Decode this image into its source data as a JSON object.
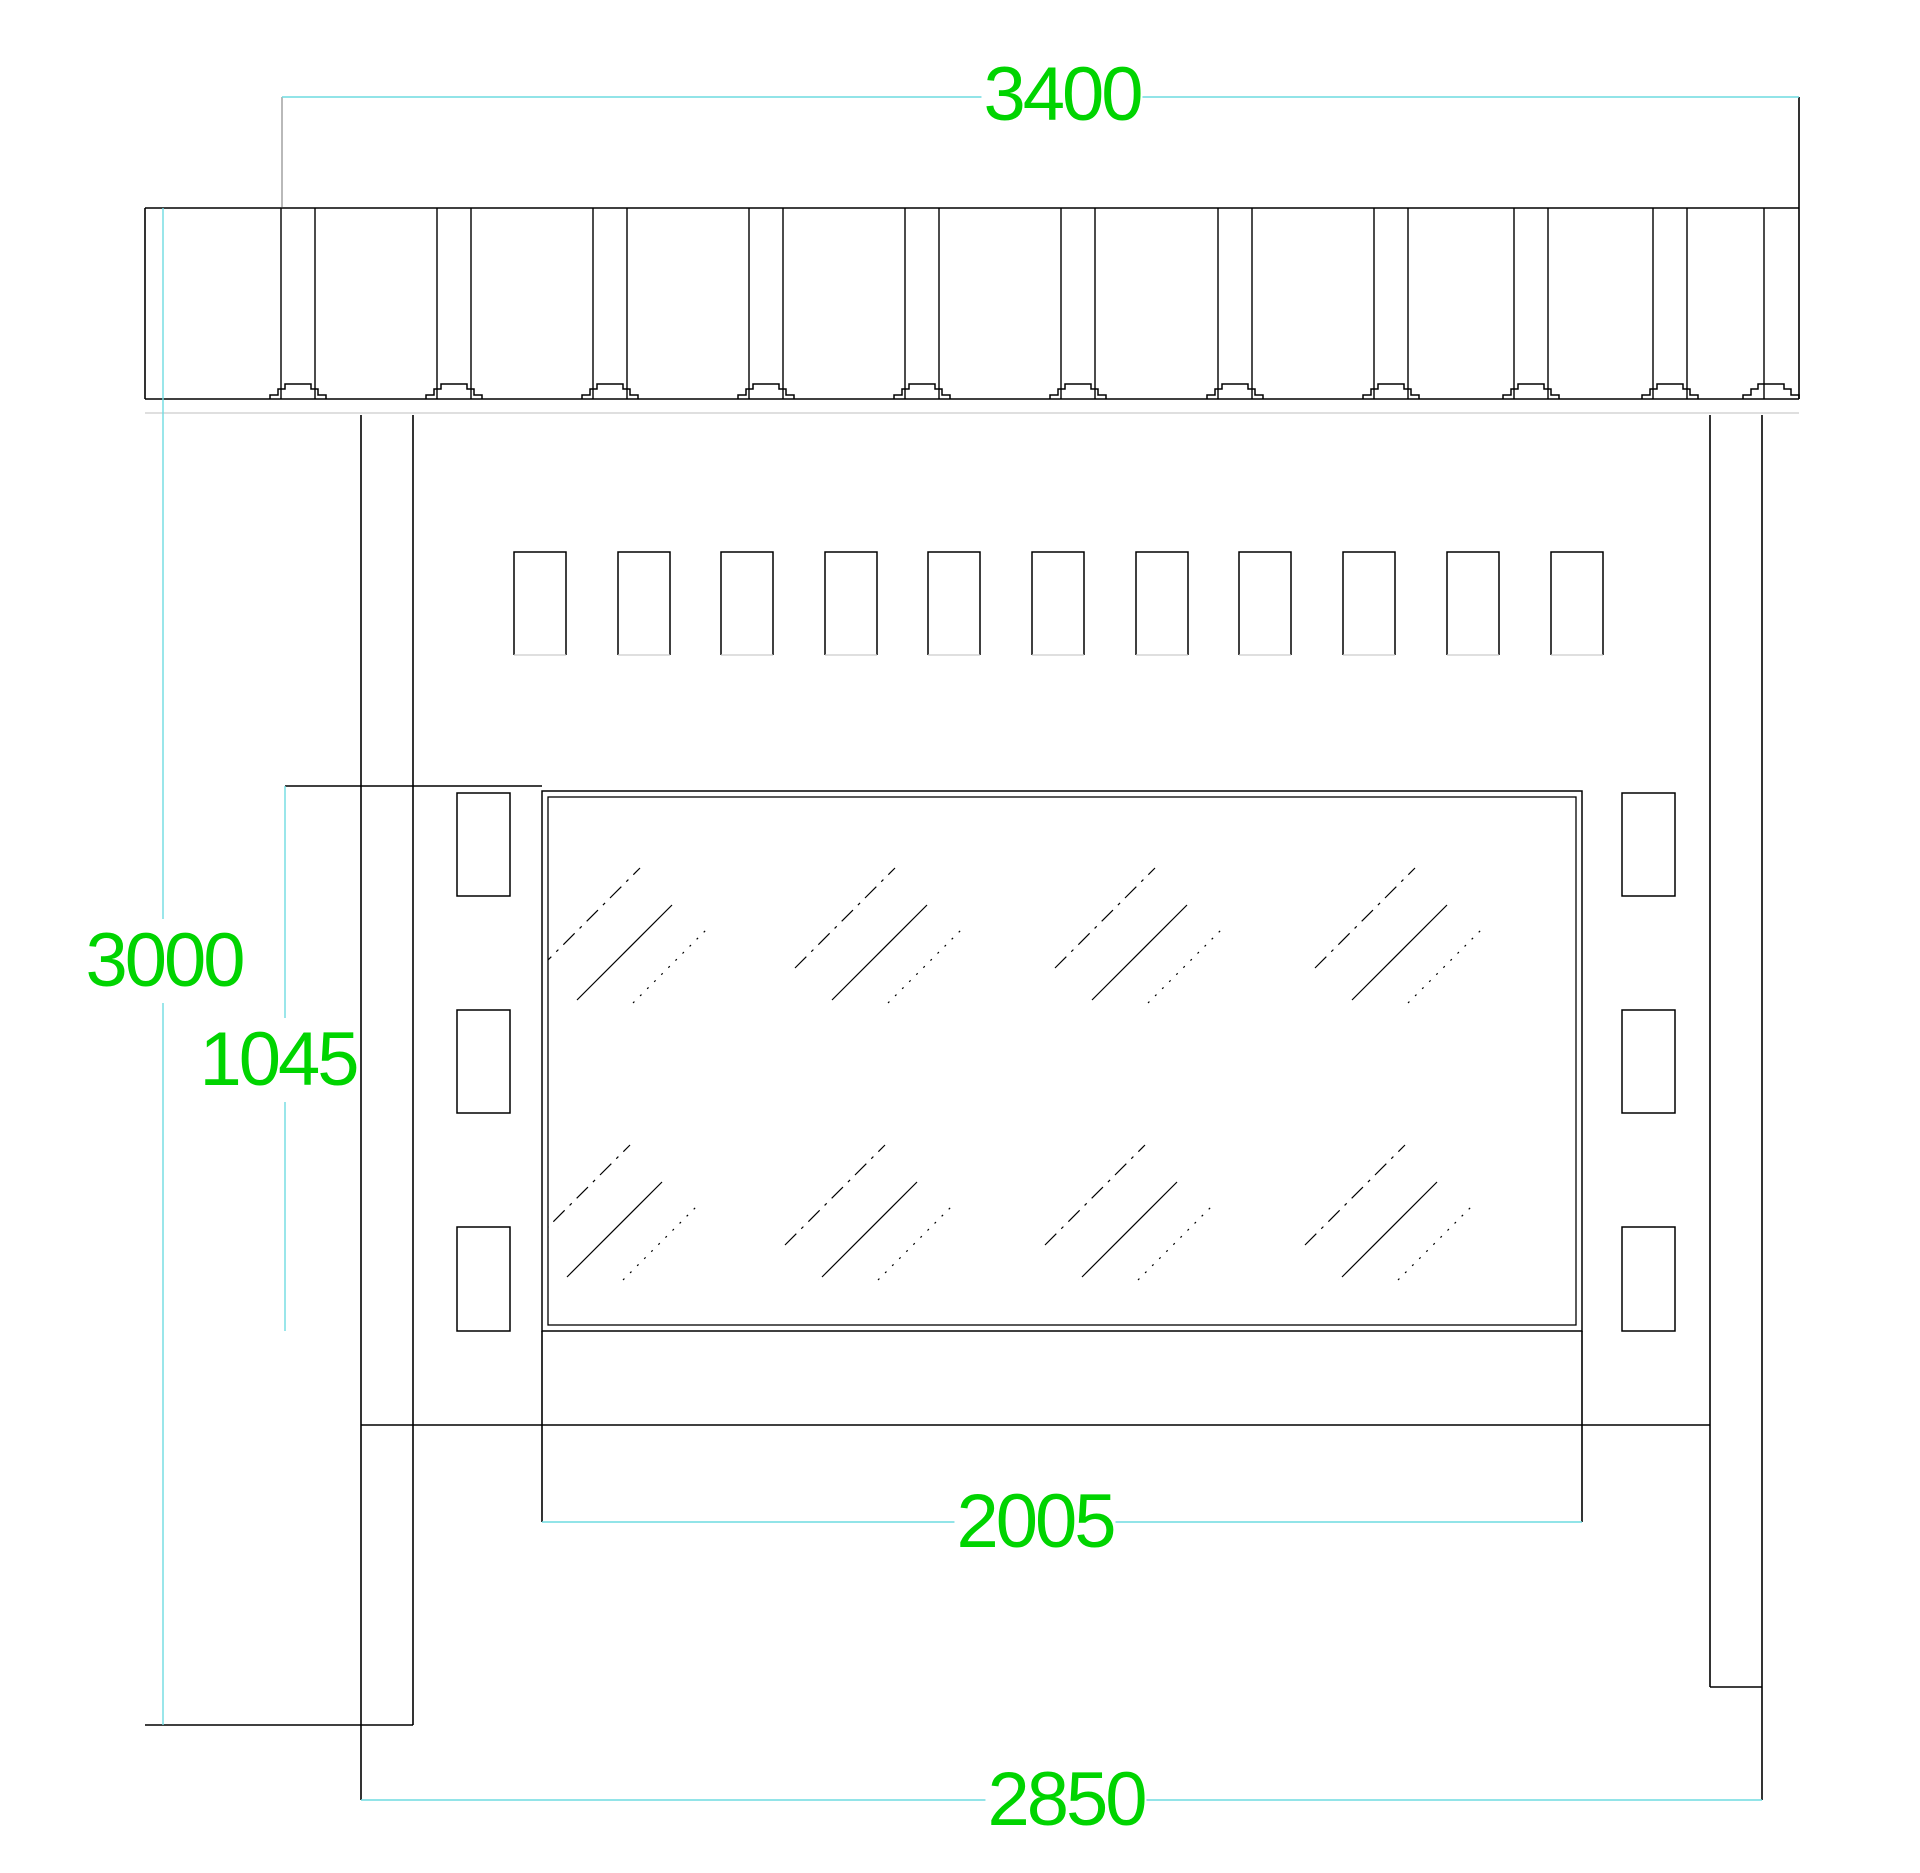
{
  "drawing": {
    "background": "#ffffff",
    "colors": {
      "black": "#000000",
      "cyan": "#6fdbe0",
      "green": "#00d400",
      "faint": "#cccccc",
      "gray": "#8a8a8a",
      "white": "#ffffff"
    },
    "canvas": {
      "width": 1920,
      "height": 1873
    },
    "dim_labels": [
      {
        "id": "dim-3400",
        "text": "3400",
        "x": 1062,
        "y": 95
      },
      {
        "id": "dim-3000",
        "text": "3000",
        "x": 164,
        "y": 961
      },
      {
        "id": "dim-1045",
        "text": "1045",
        "x": 278,
        "y": 1060
      },
      {
        "id": "dim-2005",
        "text": "2005",
        "x": 1035,
        "y": 1522
      },
      {
        "id": "dim-2850",
        "text": "2850",
        "x": 1066,
        "y": 1800
      }
    ],
    "segments": [
      {
        "name": "canopy-top-edge",
        "x1": 145,
        "y1": 208,
        "x2": 1799,
        "y2": 208,
        "c": "black"
      },
      {
        "name": "canopy-bottom-edge",
        "x1": 145,
        "y1": 399,
        "x2": 1799,
        "y2": 399,
        "c": "black"
      },
      {
        "name": "canopy-left-edge",
        "x1": 145,
        "y1": 208,
        "x2": 145,
        "y2": 399,
        "c": "black"
      },
      {
        "name": "canopy-right-edge-and-dim-extension",
        "x1": 1799,
        "y1": 97,
        "x2": 1799,
        "y2": 399,
        "c": "black"
      },
      {
        "name": "fascia-shadow-line",
        "x1": 145,
        "y1": 413,
        "x2": 1799,
        "y2": 413,
        "c": "faint",
        "w": 1.2
      },
      {
        "name": "post-left-outer-line",
        "x1": 361,
        "y1": 415,
        "x2": 361,
        "y2": 1800,
        "c": "black"
      },
      {
        "name": "post-left-inner-line",
        "x1": 413,
        "y1": 415,
        "x2": 413,
        "y2": 1725,
        "c": "black"
      },
      {
        "name": "post-right-inner-line",
        "x1": 1710,
        "y1": 415,
        "x2": 1710,
        "y2": 1687,
        "c": "black"
      },
      {
        "name": "post-right-outer-line",
        "x1": 1762,
        "y1": 415,
        "x2": 1762,
        "y2": 1800,
        "c": "black"
      },
      {
        "name": "wall-top-rail",
        "x1": 285,
        "y1": 786,
        "x2": 542,
        "y2": 786,
        "c": "black"
      },
      {
        "name": "wall-mid-rail",
        "x1": 361,
        "y1": 1425,
        "x2": 1710,
        "y2": 1425,
        "c": "black"
      },
      {
        "name": "kerb-line-left",
        "x1": 145,
        "y1": 1725,
        "x2": 413,
        "y2": 1725,
        "c": "black"
      },
      {
        "name": "post-base-line-right",
        "x1": 1710,
        "y1": 1687,
        "x2": 1762,
        "y2": 1687,
        "c": "black"
      },
      {
        "name": "glass-left-dim-extension",
        "x1": 542,
        "y1": 1331,
        "x2": 542,
        "y2": 1522,
        "c": "black"
      },
      {
        "name": "glass-right-dim-extension",
        "x1": 1582,
        "y1": 1331,
        "x2": 1582,
        "y2": 1522,
        "c": "black"
      },
      {
        "name": "dim-3400-extension-left",
        "x1": 282,
        "y1": 97,
        "x2": 282,
        "y2": 207,
        "c": "gray",
        "w": 1.2
      },
      {
        "name": "dim-3400-line",
        "x1": 282,
        "y1": 97,
        "x2": 1799,
        "y2": 97,
        "c": "cyan",
        "w": 1.4
      },
      {
        "name": "dim-3000-line",
        "x1": 163,
        "y1": 208,
        "x2": 163,
        "y2": 1725,
        "c": "cyan",
        "w": 1.4
      },
      {
        "name": "dim-1045-line",
        "x1": 285,
        "y1": 786,
        "x2": 285,
        "y2": 1331,
        "c": "cyan",
        "w": 1.4
      },
      {
        "name": "dim-2005-line",
        "x1": 542,
        "y1": 1522,
        "x2": 1582,
        "y2": 1522,
        "c": "cyan",
        "w": 1.4
      },
      {
        "name": "dim-2850-line",
        "x1": 361,
        "y1": 1800,
        "x2": 1762,
        "y2": 1800,
        "c": "cyan",
        "w": 1.4
      }
    ],
    "battens": {
      "lefts": [
        514,
        618,
        721,
        825,
        928,
        1032,
        1136,
        1239,
        1343,
        1447,
        1551
      ],
      "top": 552,
      "width": 52,
      "height": 103
    },
    "glass_panel": {
      "outer": {
        "x": 542,
        "y": 791,
        "w": 1040,
        "h": 540
      },
      "inner": {
        "x": 548,
        "y": 797,
        "w": 1028,
        "h": 528
      }
    },
    "brackets": {
      "lefts": [
        457,
        1622
      ],
      "width": 53,
      "rows": [
        {
          "y": 793,
          "h": 103
        },
        {
          "y": 1010,
          "h": 103
        },
        {
          "y": 1227,
          "h": 104
        }
      ]
    },
    "roof_joints": {
      "centers": [
        298,
        454,
        610,
        766,
        922,
        1078,
        1235,
        1391,
        1531,
        1670
      ],
      "pair_offset": 17,
      "top": 208,
      "bottom": 399,
      "last_joint": {
        "line_x": 1764,
        "hat_c": 1771
      }
    },
    "glass_hatch": {
      "rows": [
        {
          "y": 928,
          "xs": [
            625,
            880,
            1140,
            1400
          ]
        },
        {
          "y": 1205,
          "xs": [
            615,
            870,
            1130,
            1390
          ]
        }
      ],
      "strokes": [
        {
          "dx1": -85,
          "dy1": 40,
          "dx2": 15,
          "dy2": -60,
          "dash": "16 7 3 7"
        },
        {
          "dx1": -48,
          "dy1": 72,
          "dx2": 47,
          "dy2": -23,
          "dash": ""
        },
        {
          "dx1": 8,
          "dy1": 75,
          "dx2": 85,
          "dy2": -2,
          "dash": "2 8"
        }
      ]
    }
  }
}
